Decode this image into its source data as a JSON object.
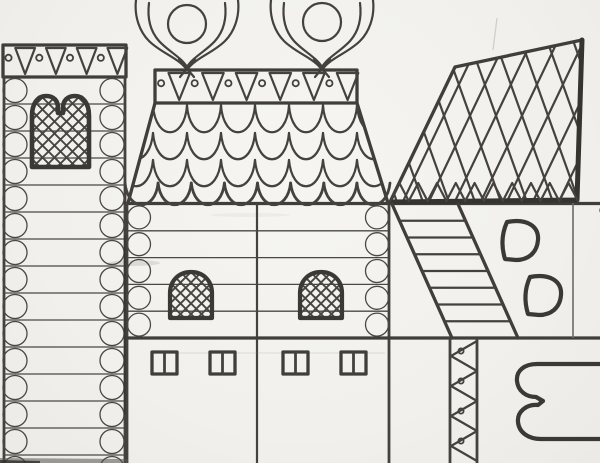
{
  "artwork": {
    "signature": "NADIA LEARNED",
    "copyright": "©",
    "description": "black-and-white hand-drawn coloring-page of folk-art log buildings"
  },
  "palette": {
    "paper": "#f2f1ed",
    "ink": "#44423e",
    "ink_heavy": "#35342f"
  },
  "drawing": {
    "tower": {
      "rows": 15
    },
    "tower_band": {
      "triangles": 4
    },
    "house_band": {
      "triangles": 6
    },
    "house_log_rows": 5,
    "roof_tile_rows": 3,
    "roof_tile_columns": 8,
    "eave_scallops": 8,
    "right_roof_hatch_lines": 11,
    "fringe_triangles": 10,
    "stair_rungs": 7,
    "zigzag_segments": 8,
    "zigzag_dots": 4,
    "small_windows_x": [
      152,
      210,
      283,
      341
    ]
  }
}
